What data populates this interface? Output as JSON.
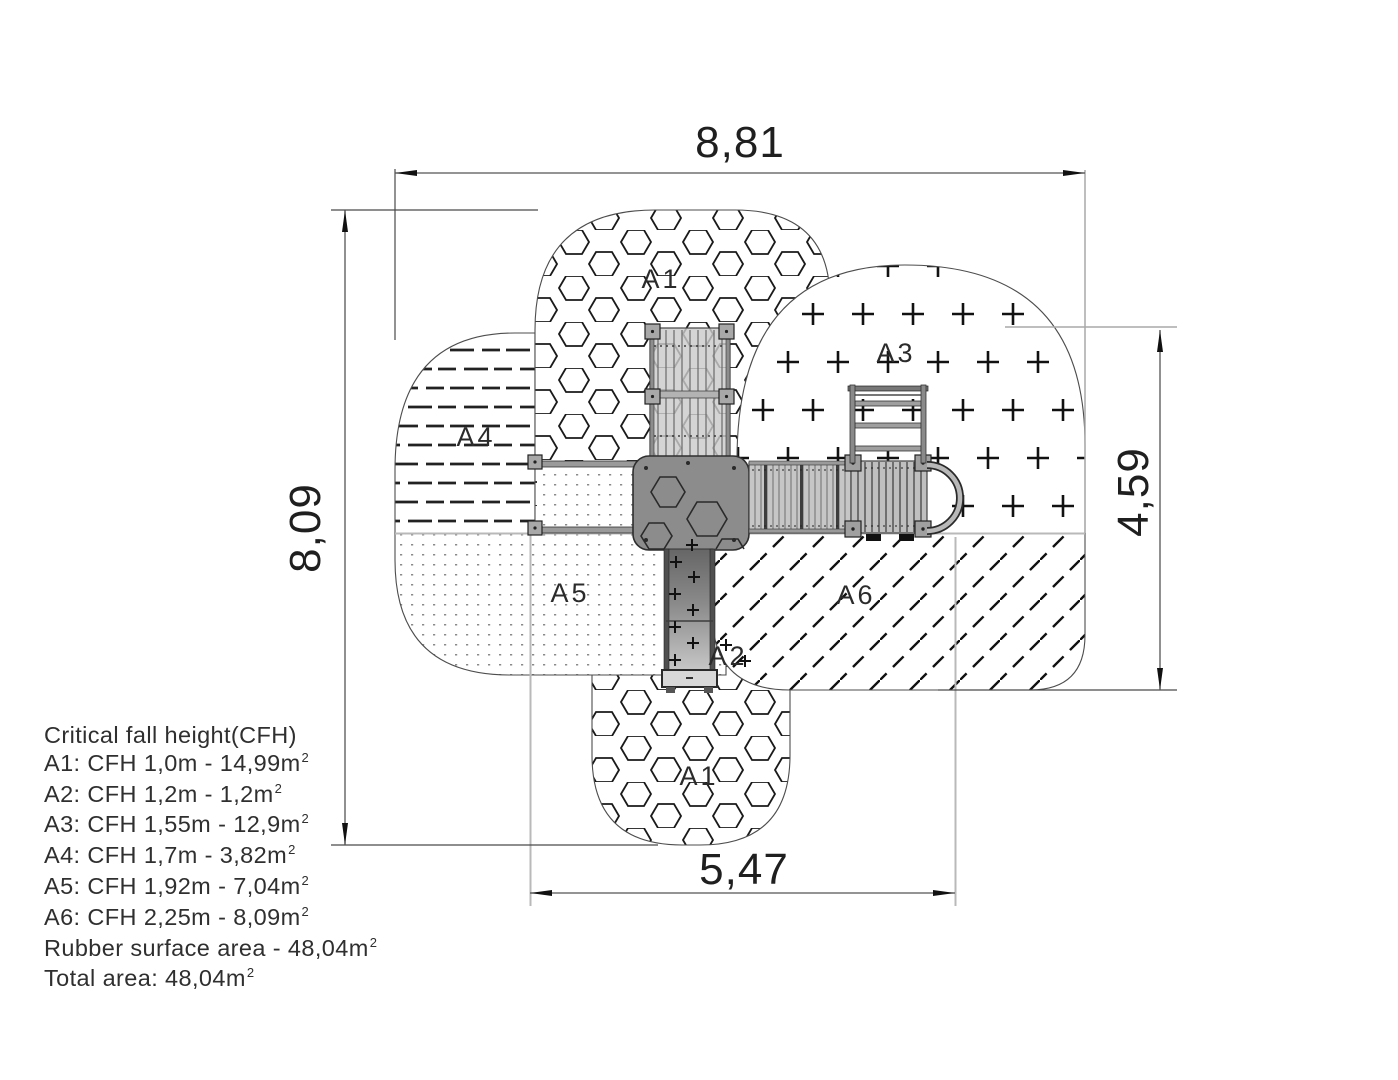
{
  "dimensions": {
    "top": "8,81",
    "left": "8,09",
    "right": "4,59",
    "bottom": "5,47"
  },
  "zones": {
    "a1_top": "A1",
    "a3": "A3",
    "a4": "A4",
    "a5": "A5",
    "a6": "A6",
    "a2": "A2",
    "a1_bottom": "A1"
  },
  "legend": {
    "title": "Critical fall height(CFH)",
    "items": [
      {
        "text": "A1: CFH 1,0m - 14,99m",
        "sup": "2"
      },
      {
        "text": "A2: CFH 1,2m - 1,2m",
        "sup": "2"
      },
      {
        "text": "A3: CFH 1,55m - 12,9m",
        "sup": "2"
      },
      {
        "text": "A4: CFH 1,7m - 3,82m",
        "sup": "2"
      },
      {
        "text": "A5: CFH 1,92m - 7,04m",
        "sup": "2"
      },
      {
        "text": "A6: CFH 2,25m - 8,09m",
        "sup": "2"
      },
      {
        "text": "Rubber surface area - 48,04m",
        "sup": "2"
      },
      {
        "text": "Total area: 48,04m",
        "sup": "2"
      }
    ]
  },
  "colors": {
    "background": "#ffffff",
    "line": "#1a1a1a",
    "guide": "#b9b9b9",
    "equipment_dark": "#8c8c8c",
    "equipment_light": "#c9c9c9"
  }
}
